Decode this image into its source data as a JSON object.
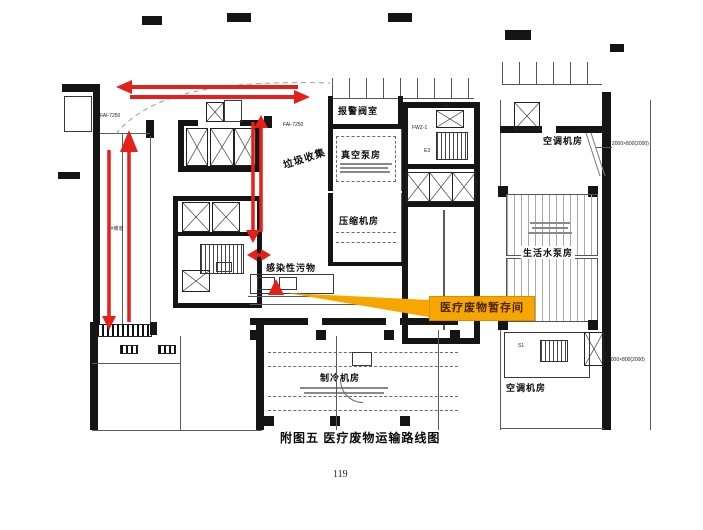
{
  "figure": {
    "caption": "附图五 医疗废物运输路线图",
    "page_number": "119"
  },
  "highlight": {
    "label": "医疗废物暂存间",
    "bg": "#F7A600",
    "text_color": "#4A2300"
  },
  "route": {
    "color": "#E3201A"
  },
  "rooms": {
    "alarm_valve": "报警阀室",
    "vacuum_pump": "真空泵房",
    "garbage_collection": "垃圾收集",
    "compressor": "压缩机房",
    "ac_top_right": "空调机房",
    "domestic_water_pump": "生活水泵房",
    "ac_bottom_right": "空调机房",
    "refrigeration": "制冷机房",
    "infectious_waste": "感染性污物",
    "ramp": "1#坡道"
  },
  "annotations": {
    "fai_left": "FAI-7250",
    "fai_center": "FAI-7250",
    "fwz_left": "FWZ-2",
    "fwz_right": "FWZ-1",
    "room_443": "443",
    "stair_e3": "E3",
    "stair_s1": "S1",
    "dim_right_top": "2000×800(2000)",
    "dim_right_bottom": "2000×800(2000)"
  }
}
